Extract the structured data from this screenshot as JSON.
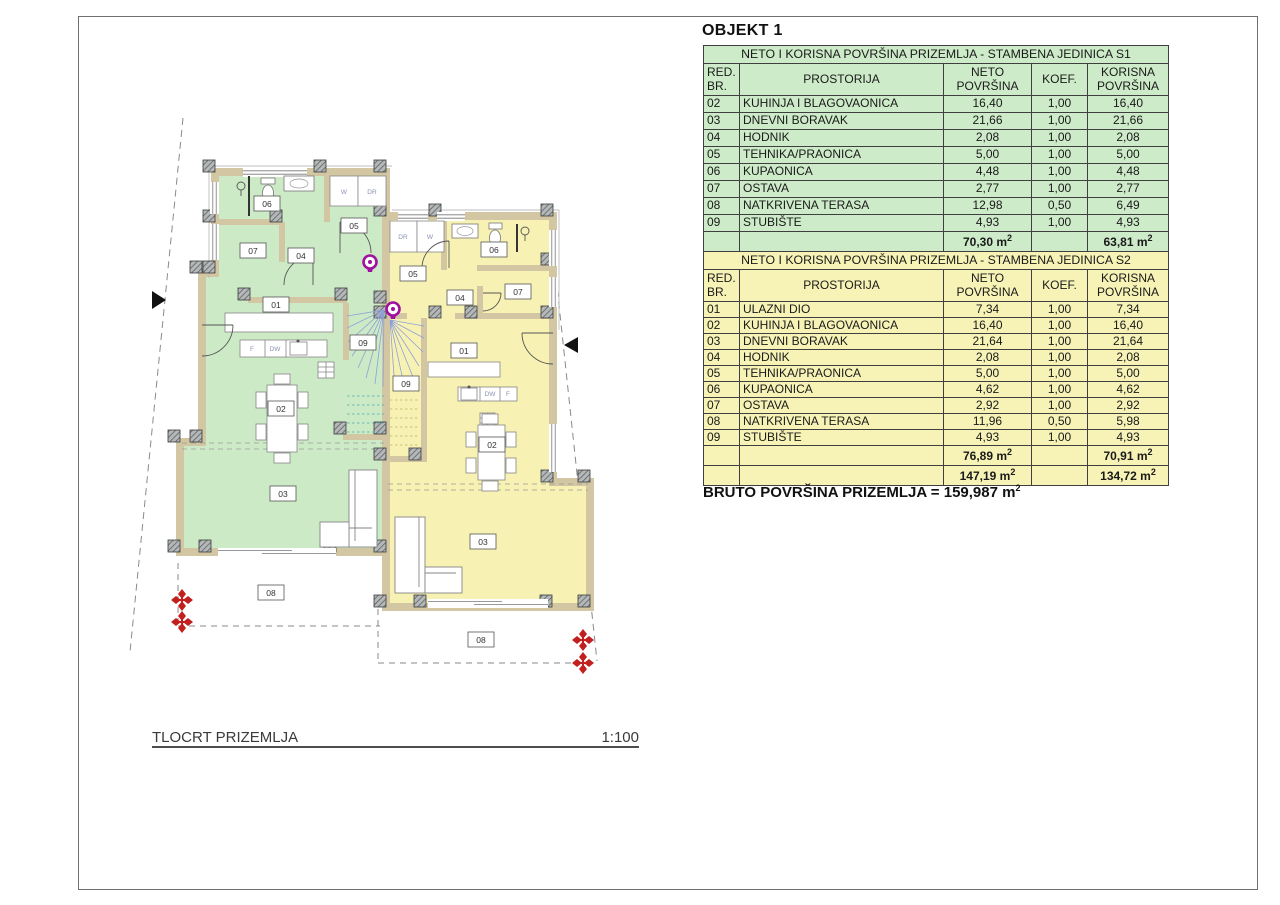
{
  "header": {
    "objekt_title": "OBJEKT 1"
  },
  "common": {
    "sup2": "2"
  },
  "table_s1": {
    "title": "NETO I KORISNA POVRŠINA PRIZEMLJA - STAMBENA JEDINICA S1",
    "col_headers": {
      "red1": "RED.",
      "red2": "BR.",
      "prostorija": "PROSTORIJA",
      "neto1": "NETO",
      "neto2": "POVRŠINA",
      "koef": "KOEF.",
      "korisna1": "KORISNA",
      "korisna2": "POVRŠINA"
    },
    "rows": [
      {
        "br": "02",
        "name": "KUHINJA I BLAGOVAONICA",
        "neto": "16,40",
        "koef": "1,00",
        "korisna": "16,40"
      },
      {
        "br": "03",
        "name": "DNEVNI BORAVAK",
        "neto": "21,66",
        "koef": "1,00",
        "korisna": "21,66"
      },
      {
        "br": "04",
        "name": "HODNIK",
        "neto": "2,08",
        "koef": "1,00",
        "korisna": "2,08"
      },
      {
        "br": "05",
        "name": "TEHNIKA/PRAONICA",
        "neto": "5,00",
        "koef": "1,00",
        "korisna": "5,00"
      },
      {
        "br": "06",
        "name": "KUPAONICA",
        "neto": "4,48",
        "koef": "1,00",
        "korisna": "4,48"
      },
      {
        "br": "07",
        "name": "OSTAVA",
        "neto": "2,77",
        "koef": "1,00",
        "korisna": "2,77"
      },
      {
        "br": "08",
        "name": "NATKRIVENA TERASA",
        "neto": "12,98",
        "koef": "0,50",
        "korisna": "6,49"
      },
      {
        "br": "09",
        "name": "STUBIŠTE",
        "neto": "4,93",
        "koef": "1,00",
        "korisna": "4,93"
      }
    ],
    "totals": {
      "neto": "70,30 m",
      "korisna": "63,81 m"
    }
  },
  "table_s2": {
    "title": "NETO I KORISNA POVRŠINA PRIZEMLJA - STAMBENA JEDINICA S2",
    "col_headers": {
      "red1": "RED.",
      "red2": "BR.",
      "prostorija": "PROSTORIJA",
      "neto1": "NETO",
      "neto2": "POVRŠINA",
      "koef": "KOEF.",
      "korisna1": "KORISNA",
      "korisna2": "POVRŠINA"
    },
    "rows": [
      {
        "br": "01",
        "name": "ULAZNI DIO",
        "neto": "7,34",
        "koef": "1,00",
        "korisna": "7,34"
      },
      {
        "br": "02",
        "name": "KUHINJA I BLAGOVAONICA",
        "neto": "16,40",
        "koef": "1,00",
        "korisna": "16,40"
      },
      {
        "br": "03",
        "name": "DNEVNI BORAVAK",
        "neto": "21,64",
        "koef": "1,00",
        "korisna": "21,64"
      },
      {
        "br": "04",
        "name": "HODNIK",
        "neto": "2,08",
        "koef": "1,00",
        "korisna": "2,08"
      },
      {
        "br": "05",
        "name": "TEHNIKA/PRAONICA",
        "neto": "5,00",
        "koef": "1,00",
        "korisna": "5,00"
      },
      {
        "br": "06",
        "name": "KUPAONICA",
        "neto": "4,62",
        "koef": "1,00",
        "korisna": "4,62"
      },
      {
        "br": "07",
        "name": "OSTAVA",
        "neto": "2,92",
        "koef": "1,00",
        "korisna": "2,92"
      },
      {
        "br": "08",
        "name": "NATKRIVENA TERASA",
        "neto": "11,96",
        "koef": "0,50",
        "korisna": "5,98"
      },
      {
        "br": "09",
        "name": "STUBIŠTE",
        "neto": "4,93",
        "koef": "1,00",
        "korisna": "4,93"
      }
    ],
    "totals": {
      "neto": "76,89 m",
      "korisna": "70,91 m"
    },
    "grand_totals": {
      "neto": "147,19 m",
      "korisna": "134,72 m"
    }
  },
  "bruto": {
    "text": "BRUTO POVRŠINA PRIZEMLJA = 159,987 m"
  },
  "titleblock": {
    "title": "TLOCRT PRIZEMLJA",
    "scale": "1:100"
  },
  "floorplan": {
    "labels": {
      "01": "01",
      "02": "02",
      "03": "03",
      "04": "04",
      "05": "05",
      "06": "06",
      "07": "07",
      "08": "08",
      "09": "09",
      "w": "W",
      "dr": "DR",
      "f": "F",
      "dw": "DW"
    }
  },
  "colors": {
    "s1_green": "#cdebc8",
    "s2_yellow": "#f7f3b6",
    "wall_tan": "#d2c7a2",
    "marker_red": "#c41f1f",
    "marker_magenta": "#a011a0",
    "stair_blue": "#8fa0d8"
  }
}
